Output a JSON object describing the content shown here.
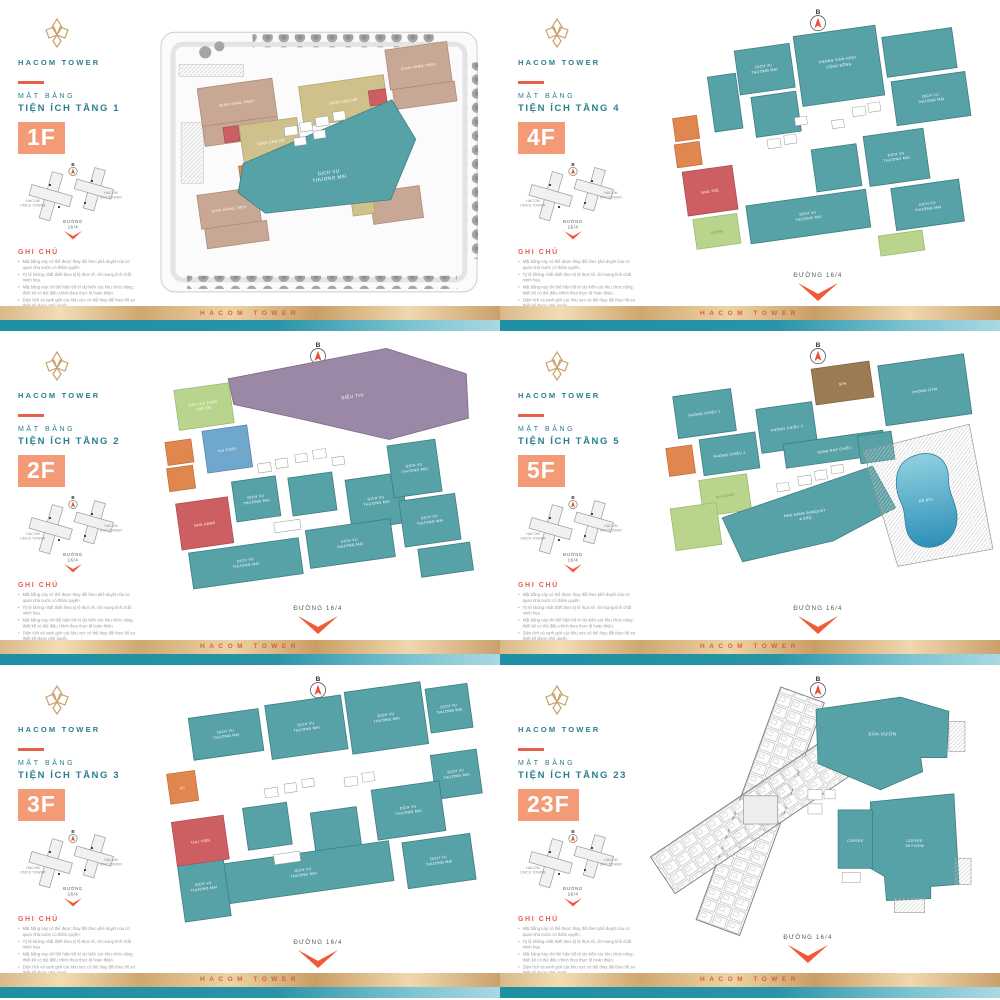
{
  "brand": {
    "name": "HACOM TOWER",
    "footer_text": "HACOM TOWER"
  },
  "labels": {
    "mat_bang": "MẶT BẰNG",
    "ghi_chu": "GHI CHÚ",
    "duong": "ĐƯỜNG 16/4",
    "duong_line1": "ĐƯỜNG",
    "duong_line2": "16/4",
    "north": "B",
    "map_left1": "HACOM",
    "map_left2": "CMCS TOWER",
    "map_right1": "HACOM",
    "map_right2": "SKY TOWER",
    "dvtm1": "DỊCH VỤ",
    "dvtm2": "THƯƠNG MẠI"
  },
  "panels": [
    {
      "id": "1f",
      "title": "TIỆN ÍCH TẦNG 1",
      "badge": "1F"
    },
    {
      "id": "4f",
      "title": "TIỆN ÍCH TẦNG 4",
      "badge": "4F"
    },
    {
      "id": "2f",
      "title": "TIỆN ÍCH TẦNG 2",
      "badge": "2F"
    },
    {
      "id": "5f",
      "title": "TIỆN ÍCH TẦNG 5",
      "badge": "5F"
    },
    {
      "id": "3f",
      "title": "TIỆN ÍCH TẦNG 3",
      "badge": "3F"
    },
    {
      "id": "23f",
      "title": "TIỆN ÍCH TẦNG 23",
      "badge": "23F"
    }
  ],
  "zones": {
    "f1": {
      "lobby": "SẢNH CĂN HỘ",
      "retail": "GIAN HÀNG TMDV"
    },
    "f2": {
      "sieuthi": "SIÊU THỊ",
      "kids1": "KHU VUI CHƠI",
      "kids2": "TRẺ EM",
      "game": "VUI CHƠI",
      "nhahang": "NHÀ HÀNG"
    },
    "f3": {
      "thuvien": "THƯ VIỆN",
      "kt": "KT"
    },
    "f4": {
      "shc1": "PHÒNG SINH HOẠT",
      "shc2": "CỘNG ĐỒNG",
      "nhatre": "NHÀ TRẺ",
      "vuon": "VƯỜN"
    },
    "f5": {
      "pc1": "PHÒNG CHIẾU 1",
      "pc2": "PHÒNG CHIẾU 2",
      "pc3": "PHÒNG CHIẾU 3",
      "sanh": "SẢNH RẠP CHIẾU",
      "spa": "SPA",
      "gym": "PHÒNG GYM",
      "nh1": "NHÀ HÀNG BANQUET",
      "nh2": "& BBQ",
      "pool": "BỂ BƠI",
      "vc": "VUI CHƠI"
    },
    "f23": {
      "garden": "SÂN VƯỜN",
      "coffee": "COFFEE",
      "sky1": "COFFEE",
      "sky2": "SKYVIEW"
    }
  },
  "notes": [
    "Mặt bằng này có thể được thay đổi theo phê duyệt của cơ quan nhà nước có thẩm quyền.",
    "Tỷ lệ không nhất thiết theo tỷ lệ thực tế, chỉ mang tính chất minh họa.",
    "Mặt bằng này chỉ thể hiện bố trí dự kiến các khu chức năng; thiết kế có thể điều chỉnh theo thực tế hoàn thiện.",
    "Diện tích và ranh giới các khu vực có thể thay đổi theo hồ sơ thiết kế được phê duyệt.",
    "Hình ảnh và nội dung chỉ mang tính minh họa; quý khách vui lòng liên hệ chủ đầu tư để biết thêm thông tin chi tiết."
  ],
  "colors": {
    "accent_orange": "#e8604c",
    "badge_orange": "#f29b76",
    "brand_teal": "#2a7f8f",
    "zone_teal": "#57a2a7",
    "zone_purple": "#9b87a6",
    "zone_red": "#cd5f63",
    "zone_green": "#b9d58d",
    "zone_tan": "#c8a795",
    "zone_khaki": "#cfc18c",
    "zone_blue": "#6fa8cc",
    "zone_brown": "#9c7b52",
    "pool_blue": "#2e8fb8",
    "footer_gold": "#cfa770",
    "footer_teal": "#1f8fa3"
  }
}
